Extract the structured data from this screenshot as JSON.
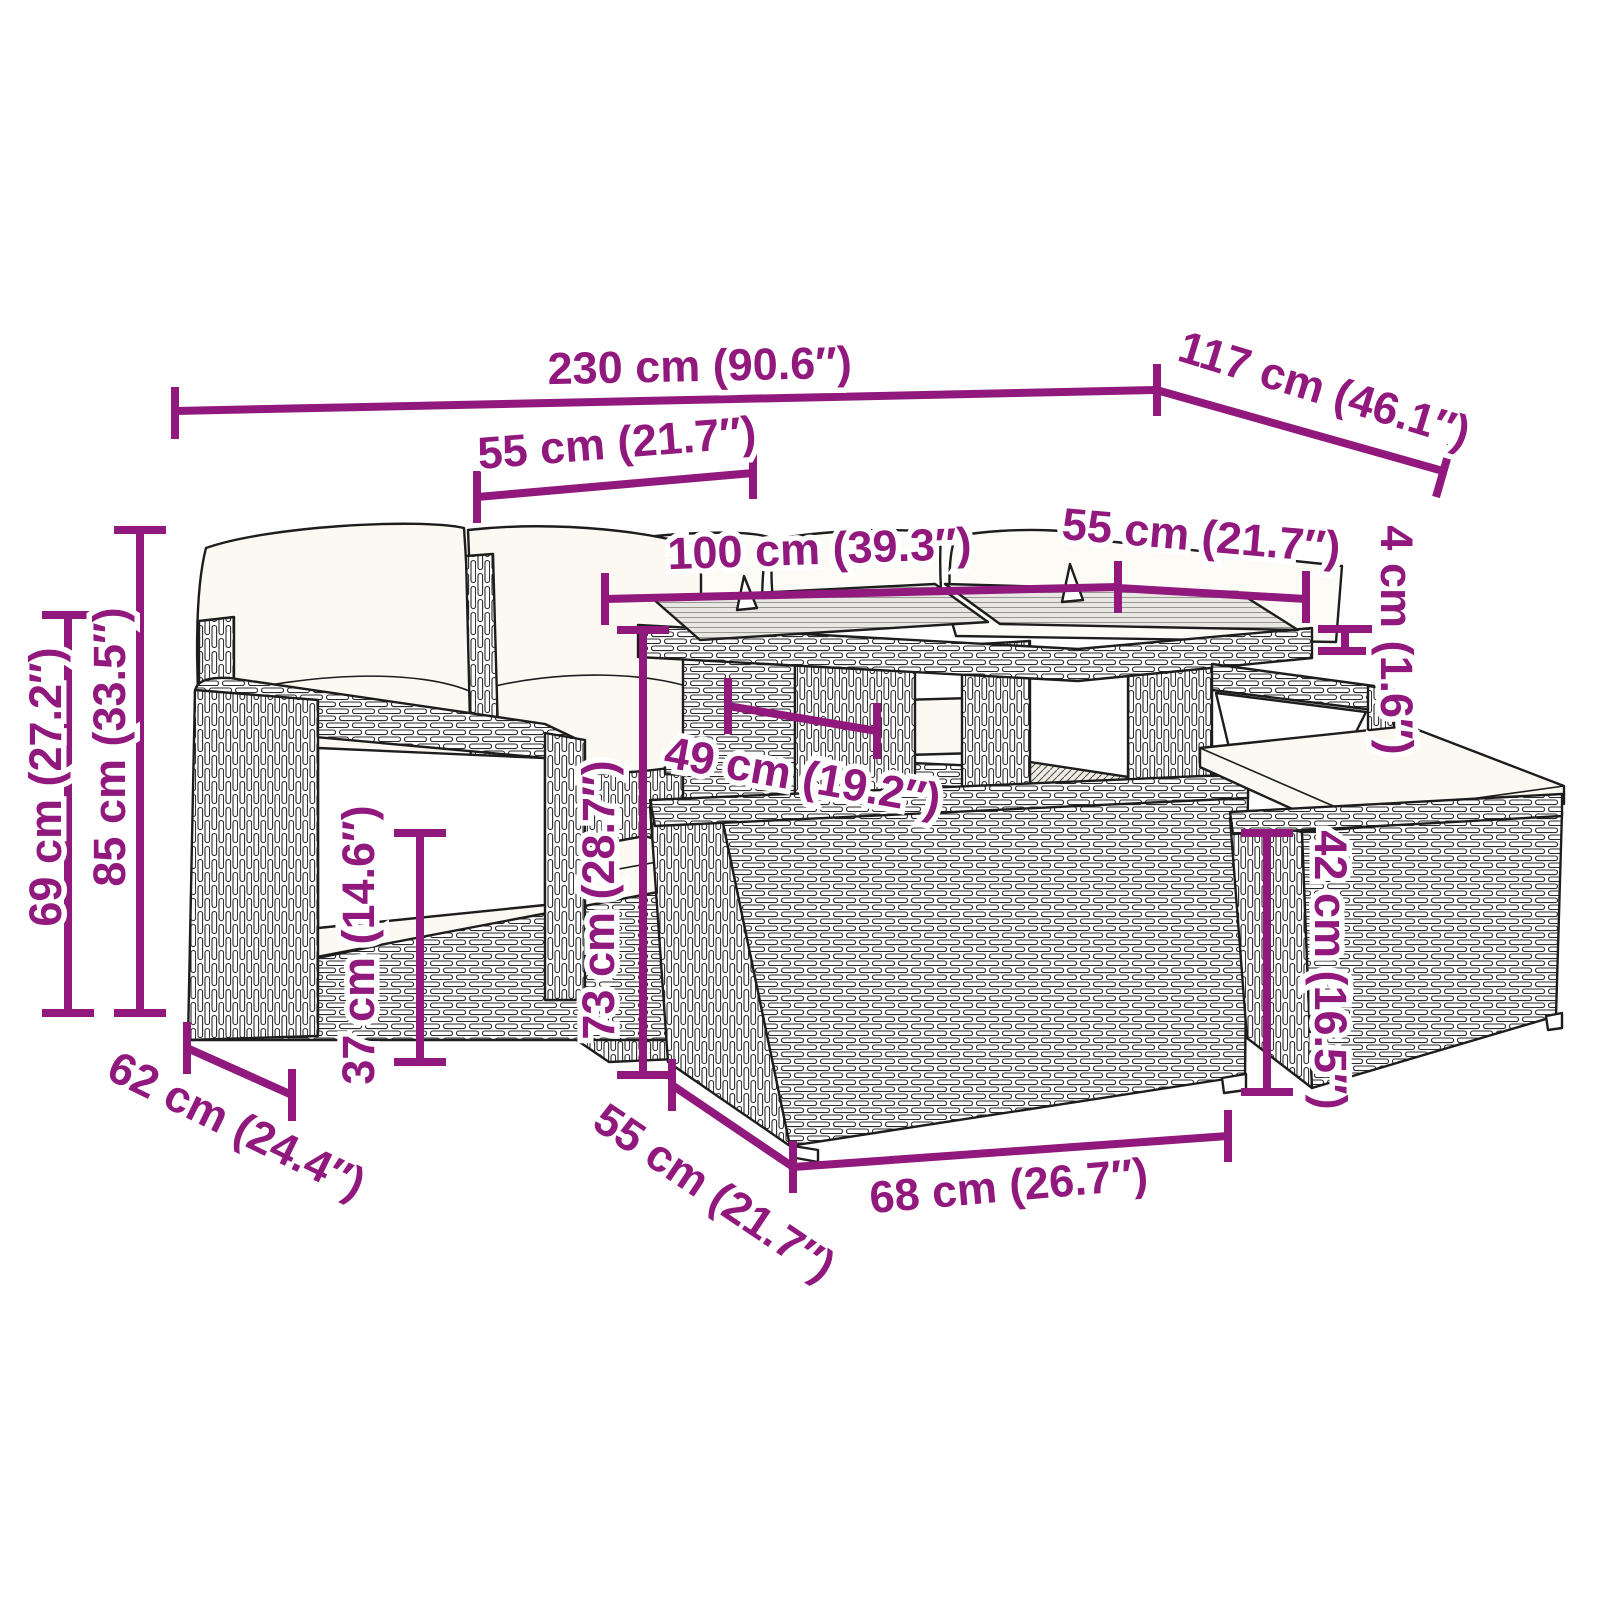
{
  "figure": {
    "kind": "product-dimension-diagram",
    "subject": "rattan garden furniture set with corner sofa, glass-top table and ottomans",
    "units": "centimeters with inches in parentheses"
  },
  "colors": {
    "dimension_accent": "#91187C",
    "line_art": "#1d1d1d",
    "background": "#ffffff",
    "cushion": "#fbf9f1"
  },
  "dimensions": {
    "total_width": "230 cm (90.6″)",
    "total_depth": "117 cm (46.1″)",
    "seat_section_width": "55 cm (21.7″)",
    "table_width": "100 cm (39.3″)",
    "table_depth": "55 cm (21.7″)",
    "glass_thickness": "4 cm (1.6″)",
    "back_height": "85 cm (33.5″)",
    "arm_height": "69 cm (27.2″)",
    "table_height": "73 cm (28.7″)",
    "seat_height": "37 cm (14.6″)",
    "ottoman_height": "42 cm (16.5″)",
    "table_clearance_width": "49 cm (19.2″)",
    "seat_depth": "62 cm (24.4″)",
    "ottoman_depth": "55 cm (21.7″)",
    "ottoman_width": "68 cm (26.7″)"
  }
}
